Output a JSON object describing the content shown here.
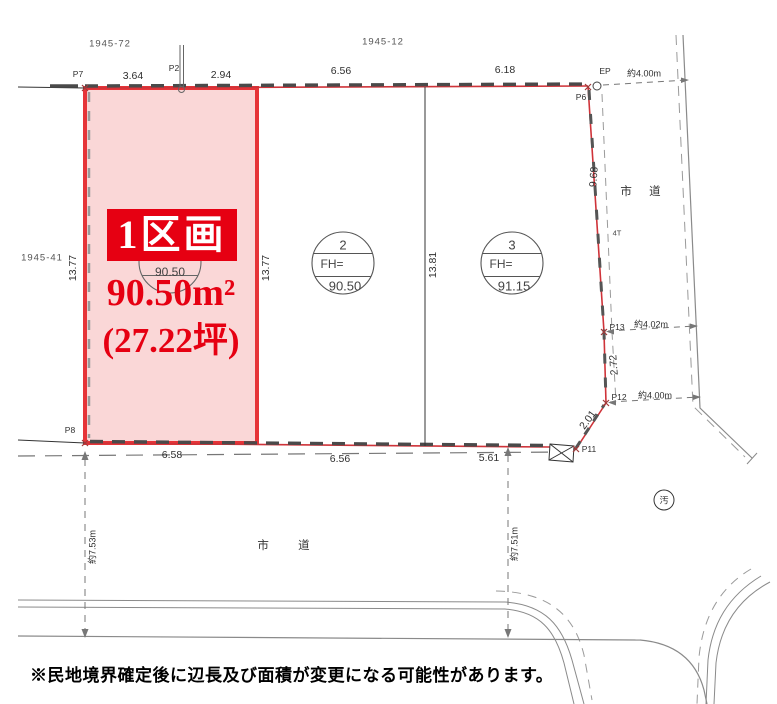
{
  "lots": {
    "top_left": "1945-72",
    "top_center": "1945-12",
    "left": "1945-41"
  },
  "points": {
    "p7": "P7",
    "p2": "P2",
    "p6": "P6",
    "ep": "EP",
    "p8": "P8",
    "p11": "P11",
    "p12": "P12",
    "p13": "P13",
    "t4": "4T"
  },
  "dims": {
    "top1": "3.64",
    "top2": "2.94",
    "top3": "6.56",
    "top4": "6.18",
    "bottom1": "6.58",
    "bottom2": "6.56",
    "bottom3": "5.61",
    "v_left": "13.77",
    "v_mid": "13.77",
    "v_div": "13.81",
    "east_upper": "9.68",
    "east_mid": "2.72",
    "east_lower": "2.01"
  },
  "road_dims": {
    "east_top": "約4.00m",
    "east_mid": "約4.02m",
    "east_low": "約4.00m",
    "south_left": "約7.53m",
    "south_right": "約7.51m"
  },
  "roads": {
    "east": "市 道",
    "south": "市 道"
  },
  "parcel1": {
    "badge": "1区画",
    "area": "90.50m²",
    "tsubo": "(27.22坪)",
    "fh": "90.50"
  },
  "parcel2": {
    "no": "2",
    "fh_label": "FH=",
    "fh": "90.50"
  },
  "parcel3": {
    "no": "3",
    "fh_label": "FH=",
    "fh": "91.15"
  },
  "manhole": {
    "label": "汚"
  },
  "note": {
    "text": "※民地境界確定後に辺長及び面積が変更になる可能性があります。"
  },
  "colors": {
    "accent_red": "#e60012",
    "parcel_fill": "#fad7d7",
    "parcel_border": "#e63438"
  }
}
